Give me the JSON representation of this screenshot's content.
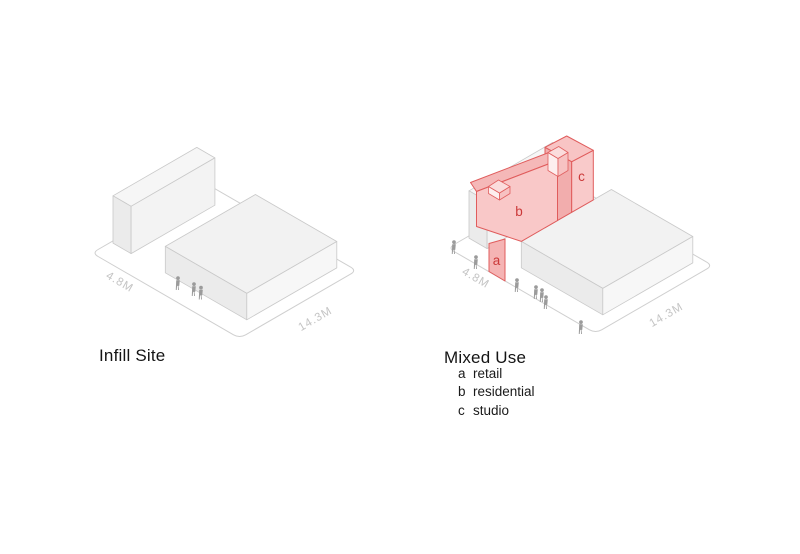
{
  "page": {
    "background_color": "#ffffff"
  },
  "colors": {
    "site_outline": "#cfcfcf",
    "existing_building_fill": "#f3f3f3",
    "existing_building_stroke": "#c9c9c9",
    "proposal_fill": "#f9c8c8",
    "proposal_stroke": "#e05c5c",
    "proposal_label_text": "#cb3939",
    "dimension_text": "#c4c4c4",
    "person_figure": "#9b9b9b",
    "title_text": "#141414"
  },
  "icons": {
    "person": "person-silhouette"
  },
  "diagrams": {
    "infill": {
      "title": "Infill Site",
      "dim_left": "4.8M",
      "dim_right": "14.3M"
    },
    "mixed": {
      "title": "Mixed Use",
      "dim_left": "4.8M",
      "dim_right": "14.3M",
      "unit_labels": {
        "a": "a",
        "b": "b",
        "c": "c"
      },
      "legend": [
        {
          "key": "a",
          "label": "retail"
        },
        {
          "key": "b",
          "label": "residential"
        },
        {
          "key": "c",
          "label": "studio"
        }
      ]
    }
  }
}
